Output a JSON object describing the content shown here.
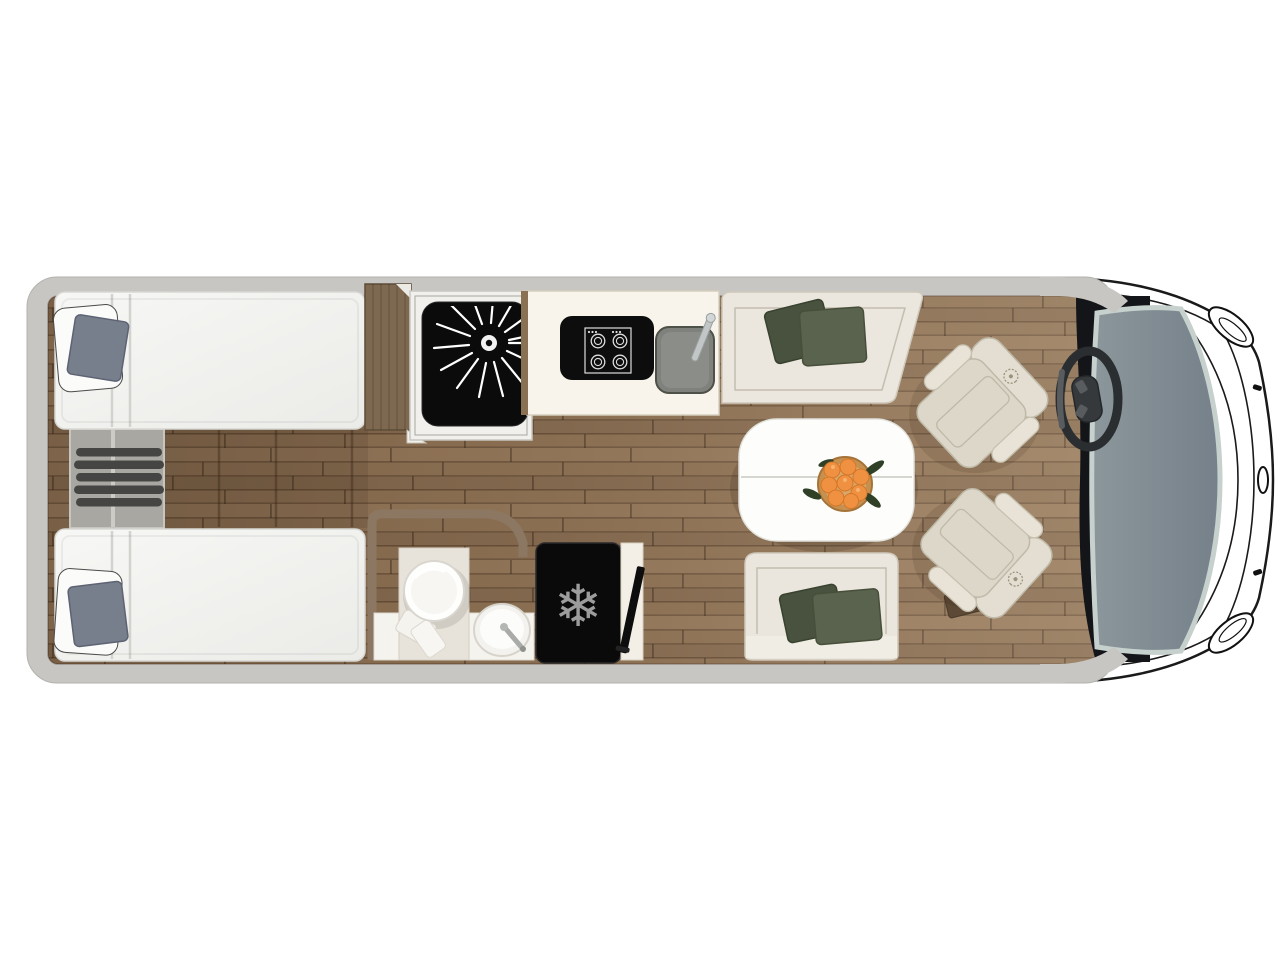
{
  "page": {
    "title": "Motorhome floor plan - top view"
  },
  "colors": {
    "wall_gray": "#c7c6c2",
    "floor_wood": "#8c7053",
    "furniture_cream": "#eae6dd",
    "pillow_green_dark": "#48523e",
    "pillow_green_light": "#5a634d",
    "bed_cushion_blue_gray": "#777e8c",
    "appliance_black": "#0b0b0b",
    "windshield_gray": "#7f8a8f",
    "orange_fruit": "#ef9140",
    "bathroom_wall_wood": "#8c7862"
  },
  "floorplan": {
    "vehicle_label": "motorhome body top view",
    "bedroom": {
      "label": "rear twin bedroom",
      "bed_top_label": "single bed with pillow and cushion",
      "bed_bottom_label": "single bed with pillow and cushion",
      "ladder_label": "bed access ladder",
      "steps_label": "bedroom floor steps",
      "wardrobe_label": "wardrobe cabinet"
    },
    "bathroom": {
      "label": "washroom",
      "shower_label": "shower cubicle with drain",
      "toilet_label": "toilet",
      "basin_label": "washbasin with tap",
      "wall_label": "curved partition wall"
    },
    "kitchen": {
      "label": "kitchenette",
      "hob_label": "four burner hob",
      "sink_label": "kitchen sink with tap",
      "counter_label": "kitchen worktop",
      "fridge_label": "refrigerator",
      "tv_label": "television panel"
    },
    "lounge": {
      "label": "dinette lounge",
      "sofa_top_label": "bench sofa with cushions",
      "sofa_bottom_label": "bench sofa with cushions",
      "table_label": "dinette table",
      "fruit_bowl_label": "bowl of oranges",
      "chair_front_label": "swivel captain chair",
      "chair_rear_label": "swivel captain chair"
    },
    "cab": {
      "label": "driver cab",
      "windshield_label": "windshield",
      "steering_wheel_label": "steering wheel",
      "dashboard_label": "dashboard",
      "headlight_top_label": "headlight",
      "headlight_bottom_label": "headlight",
      "hood_label": "bonnet outline"
    }
  },
  "icons": {
    "snowflake": {
      "name": "snowflake-icon",
      "glyph": "❄"
    }
  }
}
